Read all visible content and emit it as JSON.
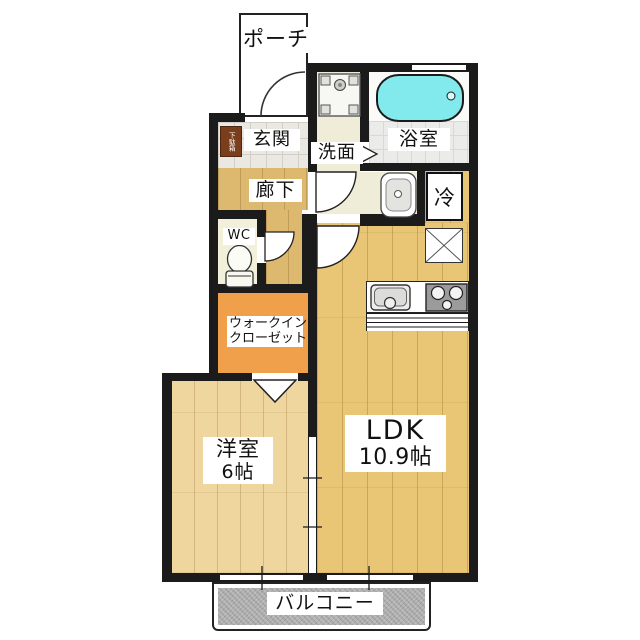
{
  "rooms": {
    "porch": {
      "label": "ポーチ"
    },
    "entrance": {
      "label": "玄関"
    },
    "shoe_cabinet": {
      "label": "下駄箱"
    },
    "hallway": {
      "label": "廊下"
    },
    "toilet": {
      "label": "WC"
    },
    "washroom": {
      "label": "洗面"
    },
    "bathroom": {
      "label": "浴室"
    },
    "refrigerator": {
      "label": "冷"
    },
    "walk_in_closet": {
      "line1": "ウォークイン",
      "line2": "クローゼット"
    },
    "western_room": {
      "label": "洋室",
      "size": "6帖"
    },
    "ldk": {
      "label": "LDK",
      "size": "10.9帖"
    },
    "balcony": {
      "label": "バルコニー"
    }
  },
  "colors": {
    "wall": "#1b1b1b",
    "hallway_wood": "#DDB86F",
    "western_room_wood": "#EED69E",
    "ldk_wood": "#E8C676",
    "closet_orange": "#F0A04B",
    "bathtub_cyan": "#82E9ED",
    "balcony_gray": "#ADADAD",
    "shoe_cabinet_brown": "#7A3E1D"
  }
}
